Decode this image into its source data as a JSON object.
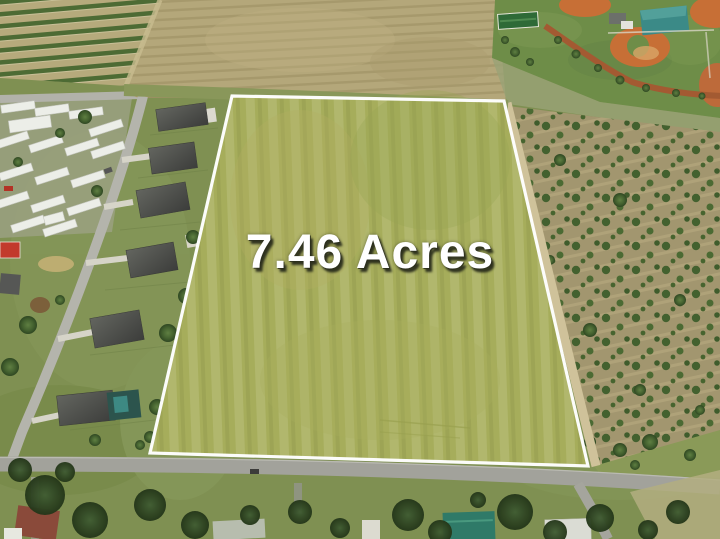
{
  "overlay": {
    "acreage_text": "7.46 Acres"
  },
  "colors": {
    "text": "#ffffff",
    "text_shadow": "#2a2d1c",
    "parcel_boundary": "#ffffff",
    "parcel_field": "#a6ad5b",
    "surrounding_grass": "#7f9052",
    "plowed_field": "#b4a77a",
    "road": "#a2a29b",
    "baseball_clay": "#c76f36",
    "pavilion_roof": "#3b8a87",
    "teal_house_roof": "#2f7a68",
    "house_roof": "#4e4f4c",
    "trailer_roof": "#eceee8",
    "orchard_ground": "#a2966f",
    "tree_green": "#43612f",
    "dirt_track": "#a35a32"
  }
}
